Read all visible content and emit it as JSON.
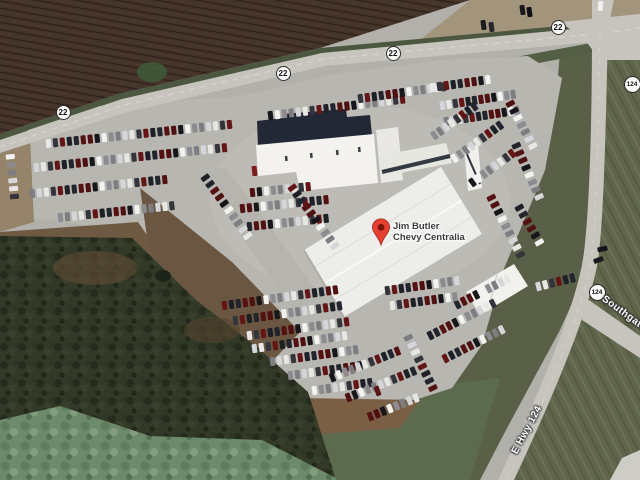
{
  "map": {
    "place_label": {
      "line1": "Jim Butler",
      "line2": "Chevy Centralia"
    },
    "route_shields": [
      {
        "route": "22",
        "x": 63,
        "y": 112
      },
      {
        "route": "22",
        "x": 283,
        "y": 73
      },
      {
        "route": "22",
        "x": 393,
        "y": 53
      },
      {
        "route": "22",
        "x": 558,
        "y": 27
      },
      {
        "route": "124",
        "x": 632,
        "y": 84
      },
      {
        "route": "124",
        "x": 597,
        "y": 292
      }
    ],
    "road_labels": [
      {
        "text": "E Hwy 124",
        "x": 527,
        "y": 430,
        "rot": -62
      },
      {
        "text": "Southgate",
        "x": 598,
        "y": 308,
        "rot": 36
      }
    ],
    "colors": {
      "pin": "#e5402f",
      "pin_hole": "#7d150b",
      "shield_bg": "#fdfdfb",
      "shield_border": "#2b2b2b",
      "place_text": "#3a3a3a",
      "road_label_text": "#ffffff"
    }
  },
  "scenery": {
    "car_palette": [
      "#e8e7e3",
      "#16161b",
      "#641616",
      "#8b8b90",
      "#22252e",
      "#d6d6da",
      "#4e1010",
      "#33343c",
      "#f2f2f0",
      "#1d2026",
      "#7d7d82",
      "#551212"
    ],
    "car_rows": [
      {
        "x": 46,
        "y": 139,
        "rot": -6,
        "n": 27,
        "g": 7
      },
      {
        "x": 34,
        "y": 163,
        "rot": -6,
        "n": 28,
        "g": 7
      },
      {
        "x": 30,
        "y": 189,
        "rot": -6,
        "n": 20,
        "g": 7
      },
      {
        "x": 58,
        "y": 213,
        "rot": -6,
        "n": 17,
        "g": 7
      },
      {
        "x": 8,
        "y": 152,
        "rot": 84,
        "n": 6,
        "g": 8
      },
      {
        "x": 268,
        "y": 111,
        "rot": -7,
        "n": 20,
        "g": 7
      },
      {
        "x": 250,
        "y": 188,
        "rot": -6,
        "n": 9,
        "g": 7
      },
      {
        "x": 240,
        "y": 204,
        "rot": -6,
        "n": 13,
        "g": 7
      },
      {
        "x": 247,
        "y": 222,
        "rot": -6,
        "n": 12,
        "g": 7
      },
      {
        "x": 203,
        "y": 173,
        "rot": 54,
        "n": 10,
        "g": 8
      },
      {
        "x": 290,
        "y": 183,
        "rot": 54,
        "n": 10,
        "g": 8
      },
      {
        "x": 358,
        "y": 94,
        "rot": -8,
        "n": 13,
        "g": 7
      },
      {
        "x": 430,
        "y": 83,
        "rot": -8,
        "n": 9,
        "g": 7
      },
      {
        "x": 440,
        "y": 101,
        "rot": -9,
        "n": 12,
        "g": 6.5
      },
      {
        "x": 444,
        "y": 117,
        "rot": -9,
        "n": 12,
        "g": 6.5
      },
      {
        "x": 432,
        "y": 131,
        "rot": -36,
        "n": 8,
        "g": 7
      },
      {
        "x": 452,
        "y": 154,
        "rot": -36,
        "n": 9,
        "g": 7
      },
      {
        "x": 470,
        "y": 178,
        "rot": -36,
        "n": 8,
        "g": 7
      },
      {
        "x": 508,
        "y": 99,
        "rot": 62,
        "n": 7,
        "g": 8
      },
      {
        "x": 489,
        "y": 193,
        "rot": 63,
        "n": 9,
        "g": 8
      },
      {
        "x": 514,
        "y": 141,
        "rot": 66,
        "n": 8,
        "g": 8
      },
      {
        "x": 517,
        "y": 203,
        "rot": 60,
        "n": 6,
        "g": 8
      },
      {
        "x": 222,
        "y": 301,
        "rot": -8,
        "n": 17,
        "g": 7
      },
      {
        "x": 233,
        "y": 316,
        "rot": -8,
        "n": 16,
        "g": 7
      },
      {
        "x": 247,
        "y": 331,
        "rot": -8,
        "n": 15,
        "g": 7
      },
      {
        "x": 252,
        "y": 344,
        "rot": -8,
        "n": 14,
        "g": 7
      },
      {
        "x": 270,
        "y": 357,
        "rot": -8,
        "n": 13,
        "g": 7
      },
      {
        "x": 288,
        "y": 371,
        "rot": -8,
        "n": 11,
        "g": 7
      },
      {
        "x": 312,
        "y": 386,
        "rot": -8,
        "n": 9,
        "g": 7
      },
      {
        "x": 330,
        "y": 373,
        "rot": -22,
        "n": 11,
        "g": 7
      },
      {
        "x": 346,
        "y": 393,
        "rot": -22,
        "n": 11,
        "g": 7
      },
      {
        "x": 368,
        "y": 412,
        "rot": -22,
        "n": 8,
        "g": 7
      },
      {
        "x": 455,
        "y": 300,
        "rot": -27,
        "n": 9,
        "g": 7
      },
      {
        "x": 428,
        "y": 331,
        "rot": -27,
        "n": 11,
        "g": 7
      },
      {
        "x": 443,
        "y": 354,
        "rot": -27,
        "n": 10,
        "g": 7
      },
      {
        "x": 385,
        "y": 286,
        "rot": -8,
        "n": 11,
        "g": 7
      },
      {
        "x": 390,
        "y": 301,
        "rot": -8,
        "n": 10,
        "g": 7
      },
      {
        "x": 536,
        "y": 282,
        "rot": -14,
        "n": 6,
        "g": 7
      },
      {
        "x": 406,
        "y": 333,
        "rot": 64,
        "n": 8,
        "g": 8
      }
    ],
    "vehicles": [
      {
        "x": 520,
        "y": 5,
        "rot": -8,
        "c": "#17171c"
      },
      {
        "x": 527,
        "y": 7,
        "rot": -8,
        "c": "#0f0f13"
      },
      {
        "x": 481,
        "y": 20,
        "rot": -8,
        "c": "#1b1b20"
      },
      {
        "x": 489,
        "y": 22,
        "rot": -8,
        "c": "#26262c"
      },
      {
        "x": 598,
        "y": 1,
        "rot": 5,
        "c": "#f0f0ee"
      },
      {
        "x": 600,
        "y": 244,
        "rot": 78,
        "c": "#141419"
      },
      {
        "x": 596,
        "y": 255,
        "rot": 70,
        "c": "#1a1a1f"
      },
      {
        "x": 252,
        "y": 166,
        "rot": -6,
        "c": "#7e1d1d"
      },
      {
        "x": 375,
        "y": 386,
        "rot": -20,
        "c": "#5d1414"
      }
    ]
  }
}
